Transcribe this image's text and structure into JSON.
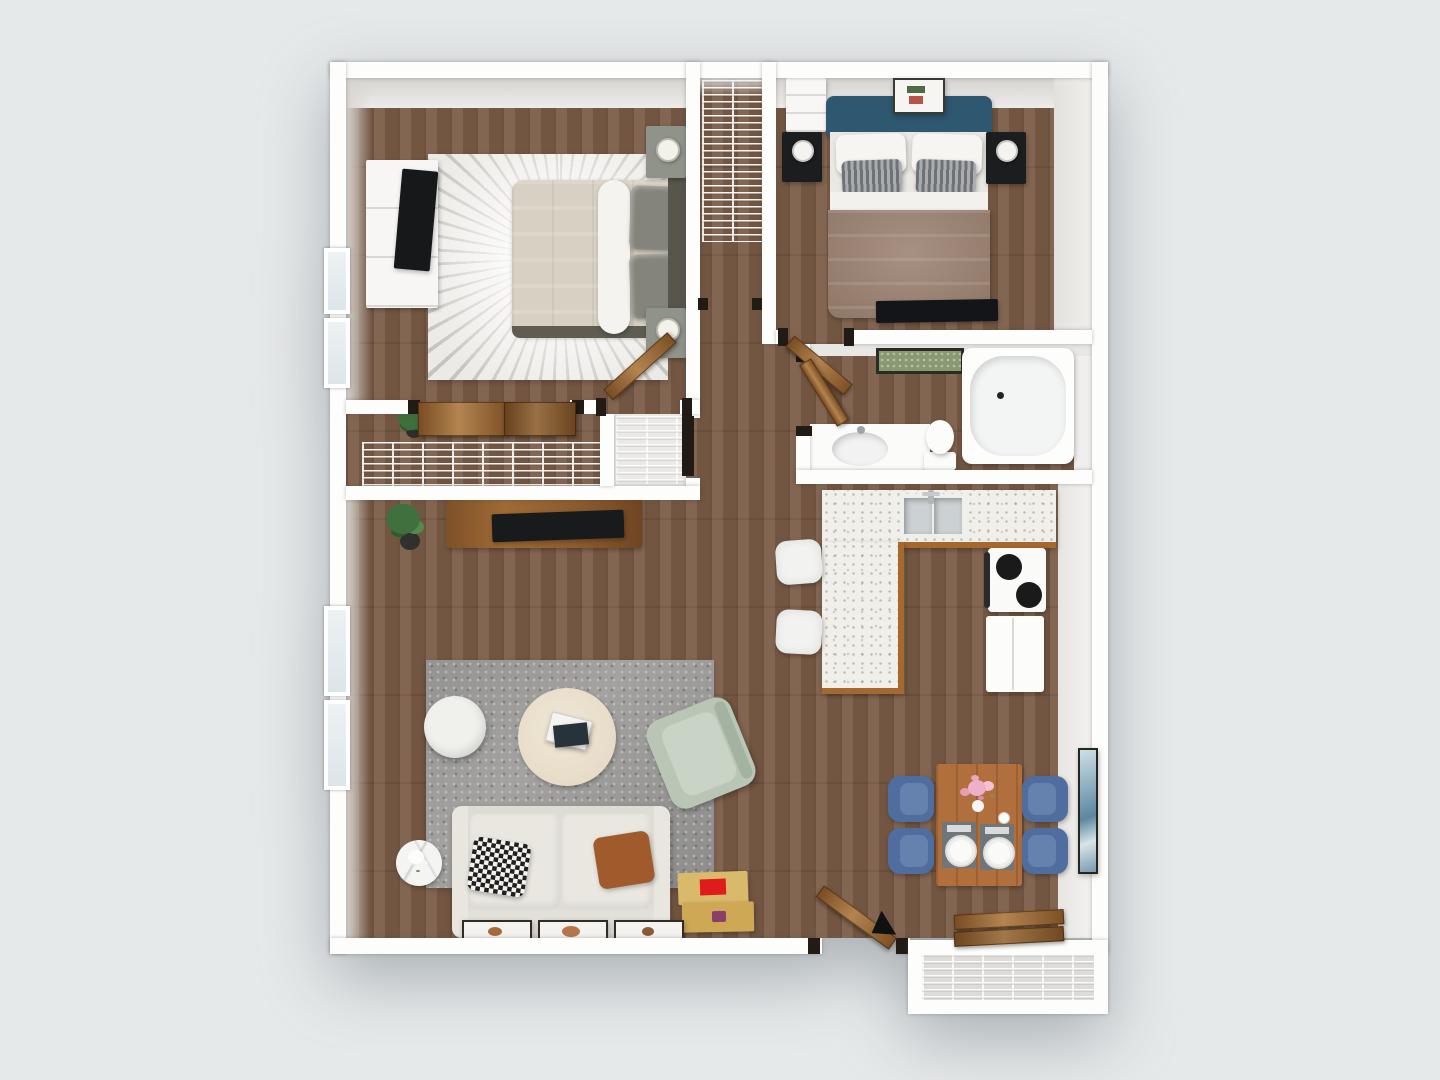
{
  "scene": {
    "description": "Top-down 3D rendered floor plan of a two-bedroom apartment",
    "background_color": "#e6e9ea",
    "wall_color": "#fdfdfc",
    "floor_material": "wood-plank"
  },
  "palette": {
    "wood_floor": "#7b5c47",
    "wall_face_gray": "#d8d5d1",
    "door_wood": "#9a6733",
    "bed1_duvet": "#d8d1c3",
    "bed1_pillow_gray": "#84847c",
    "bed2_headboard_teal": "#2e5770",
    "bed2_duvet_taupe": "#9b8170",
    "nightstand_black": "#1c1d1f",
    "rug_bedroom1": "#eceae6",
    "rug_living_gray": "#a3a2a0",
    "sofa_cream": "#e9e7e0",
    "armchair_sage": "#b9c6b6",
    "coffee_table_cream": "#e9dfcd",
    "pillow_rust": "#a05a2c",
    "dining_chair_blue": "#4f6d9e",
    "dining_table_wood": "#b06f3d",
    "counter_terrazzo": "#f1efe9",
    "cabinet_wood": "#a5682e",
    "storage_box_yellow": "#d9b96a",
    "box_label_red": "#e01b1b",
    "bath_mat_green": "#8a9a70",
    "art_blue": "#7fa3b8"
  },
  "rooms": {
    "bedroom1": {
      "name": "Bedroom 1",
      "items": [
        "double bed with beige duvet and gray pillows",
        "white dresser with TV",
        "two nightstands with lamps",
        "round-pattern area rug",
        "two windows",
        "sliding-door closet"
      ]
    },
    "bedroom2": {
      "name": "Bedroom 2",
      "items": [
        "double bed with teal headboard and taupe duvet",
        "two black nightstands with white lamps",
        "white dresser",
        "framed wall art",
        "flat TV at foot of bed"
      ]
    },
    "closet1": {
      "name": "Closet",
      "items": [
        "wire shelving"
      ]
    },
    "closet2": {
      "name": "Hall closet",
      "items": [
        "wire shelving",
        "dark open door"
      ]
    },
    "wardrobe": {
      "name": "Wardrobe closet",
      "items": [
        "wire shelving",
        "two wood sliding doors"
      ]
    },
    "bathroom": {
      "name": "Bathroom",
      "items": [
        "vanity with round sink",
        "toilet",
        "bathtub",
        "green bath mat"
      ]
    },
    "hallway": {
      "name": "Hallway",
      "items": [
        "three open wood doors"
      ]
    },
    "kitchen": {
      "name": "Kitchen",
      "items": [
        "L-shaped terrazzo counter",
        "double-basin sink",
        "stove with two burners",
        "refrigerator",
        "two bar stools"
      ]
    },
    "living": {
      "name": "Living room",
      "items": [
        "cream sofa",
        "houndstooth pillow",
        "rust pillow",
        "round coffee table with books",
        "white pouf",
        "sage armchair",
        "marble side table with flowers",
        "gray area rug",
        "media console with TV",
        "potted plants",
        "yellow storage boxes",
        "three leaning picture frames",
        "two windows"
      ]
    },
    "dining": {
      "name": "Dining area",
      "items": [
        "wood dining table",
        "four blue chairs",
        "flower centerpiece",
        "two place settings",
        "abstract wall art"
      ]
    },
    "entry": {
      "name": "Entry",
      "items": [
        "open front door with swing mark",
        "wood bench planks"
      ]
    },
    "storage": {
      "name": "Exterior storage closet",
      "items": [
        "wire shelving"
      ]
    }
  }
}
